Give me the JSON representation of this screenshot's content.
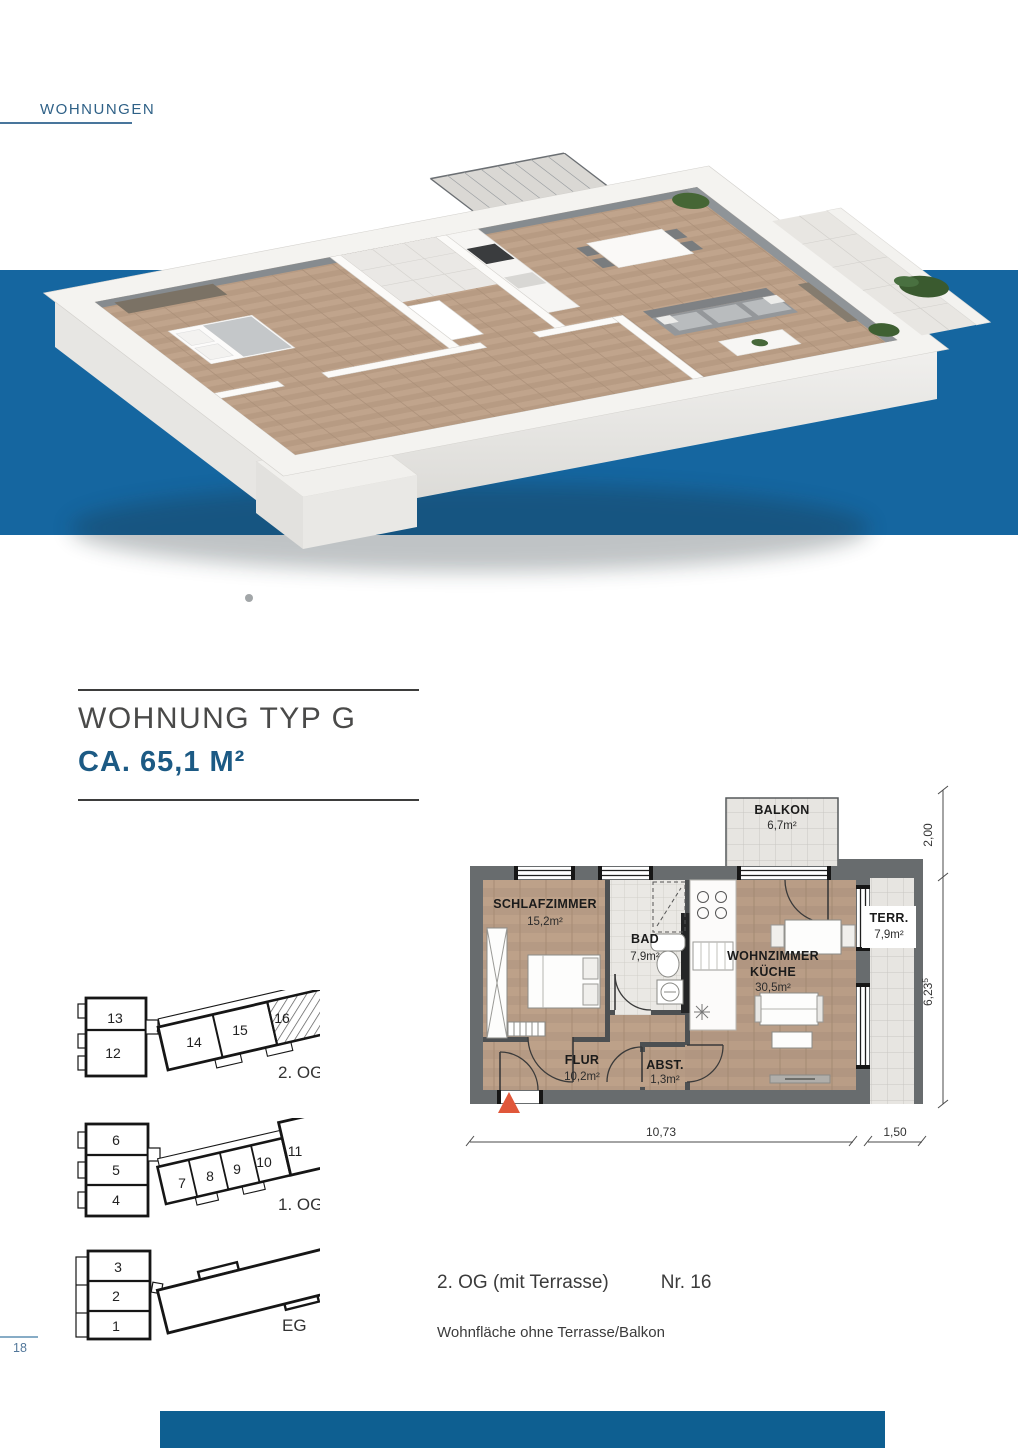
{
  "page": {
    "section_label": "WOHNUNGEN",
    "page_number": "18"
  },
  "title": {
    "name": "WOHNUNG TYP G",
    "area": "CA. 65,1 M²"
  },
  "colors": {
    "accent_blue": "#1566a0",
    "bottom_bar_blue": "#0e5f91",
    "wall_gray": "#686c6e",
    "entrance_orange": "#e0573a"
  },
  "floorplan": {
    "rooms": [
      {
        "name": "SCHLAFZIMMER",
        "area": "15,2m²"
      },
      {
        "name": "BAD",
        "area": "7,9m²"
      },
      {
        "name": "WOHNZIMMER",
        "name2": "KÜCHE",
        "area": "30,5m²"
      },
      {
        "name": "FLUR",
        "area": "10,2m²"
      },
      {
        "name": "ABST.",
        "area": "1,3m²"
      },
      {
        "name": "BALKON",
        "area": "6,7m²"
      },
      {
        "name": "TERR.",
        "area": "7,9m²"
      }
    ],
    "dimensions": {
      "balcony_depth": "2,00",
      "right_height": "6,23",
      "right_height_sup": "5",
      "bottom_width": "10,73",
      "terrace_width": "1,50"
    }
  },
  "mini_plans": [
    {
      "label": "2. OG",
      "units": [
        "13",
        "12",
        "14",
        "15",
        "16"
      ],
      "highlighted_unit": "16"
    },
    {
      "label": "1. OG",
      "units": [
        "6",
        "5",
        "4",
        "7",
        "8",
        "9",
        "10",
        "11"
      ]
    },
    {
      "label": "EG",
      "units": [
        "3",
        "2",
        "1"
      ]
    }
  ],
  "footer": {
    "floor_info": "2. OG (mit Terrasse)",
    "unit_info": "Nr. 16",
    "note": "Wohnfläche ohne Terrasse/Balkon"
  }
}
